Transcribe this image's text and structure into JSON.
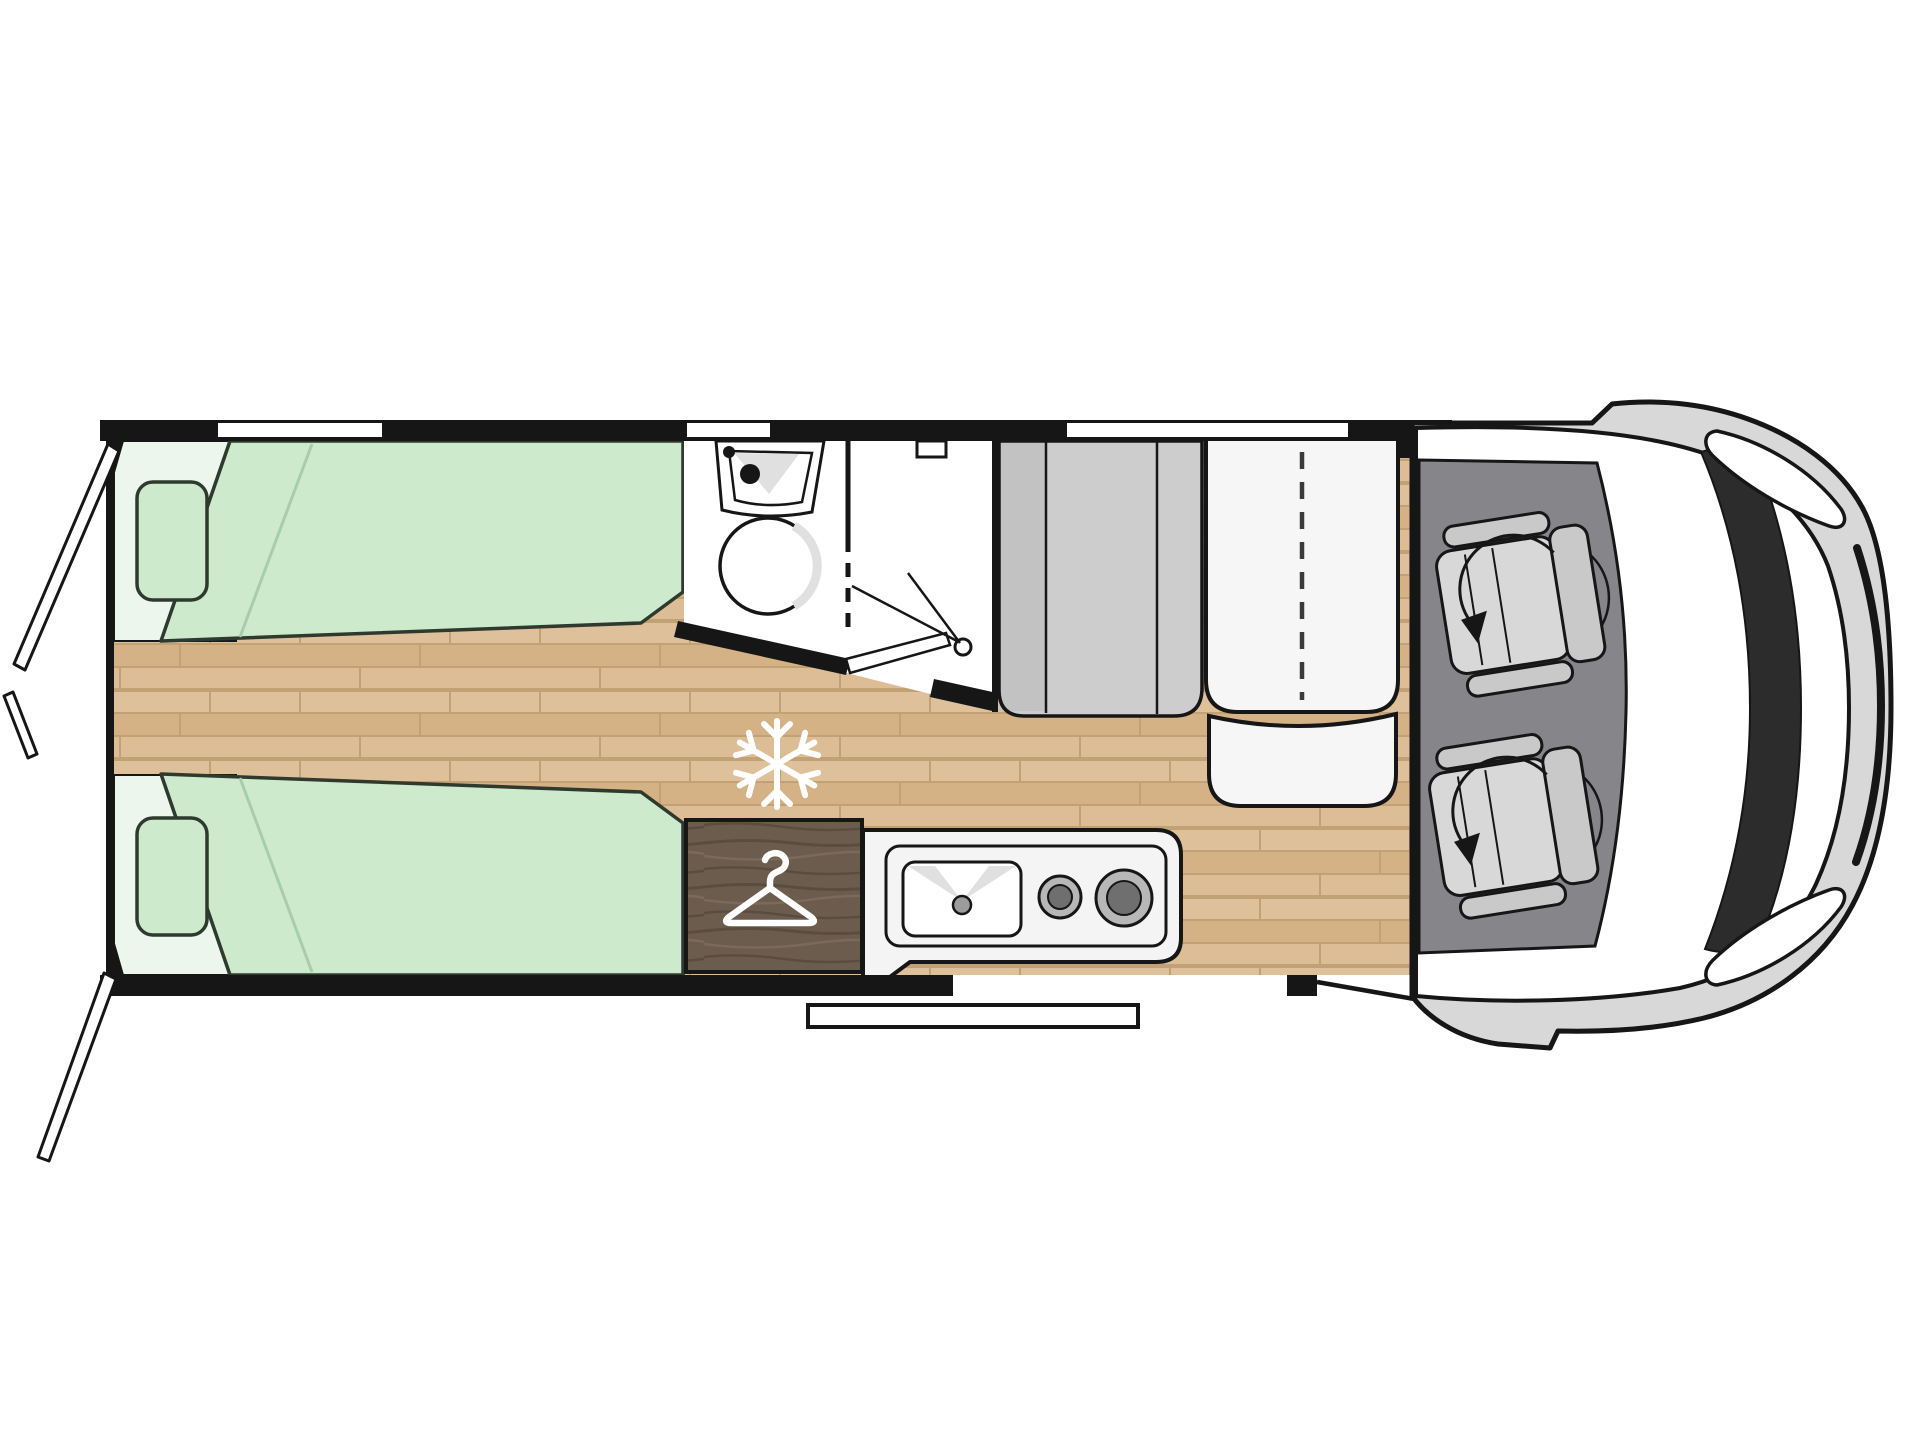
{
  "meta": {
    "title": "Motorhome floor plan, top view"
  },
  "colors": {
    "outline": "#161616",
    "wall": "#161616",
    "wood": "#d9ba8f",
    "wood_line": "#c2a175",
    "bed": "#cdeacd",
    "bed_head": "#edf6ed",
    "bed_edge": "#2f3a2f",
    "bed_crease": "#a8cda8",
    "white": "#ffffff",
    "fixture_shade": "#e0e0e0",
    "bench": "#cdcdcd",
    "bench_shade": "#c2c2c2",
    "table": "#f6f6f6",
    "dash_line": "#3a3a3a",
    "wardrobe": "#6b5c4e",
    "wardrobe_grain": "#5a4d40",
    "wardrobe_light": "#7b6a5a",
    "kitchen": "#f4f4f4",
    "burner_ring": "#b7b7b7",
    "burner_center": "#6f6f6f",
    "drain": "#9c9c9c",
    "cab_floor": "#85858a",
    "seat": "#c9c9c9",
    "seat_light": "#d8d8d8",
    "vehicle_body": "#d8d8d8",
    "windshield": "#2c2c2c",
    "icon_white": "#ffffff"
  },
  "icons": {
    "freezer": "snowflake-icon",
    "wardrobe": "hanger-icon",
    "seat_swivel": "rotate-arrow-icon"
  }
}
